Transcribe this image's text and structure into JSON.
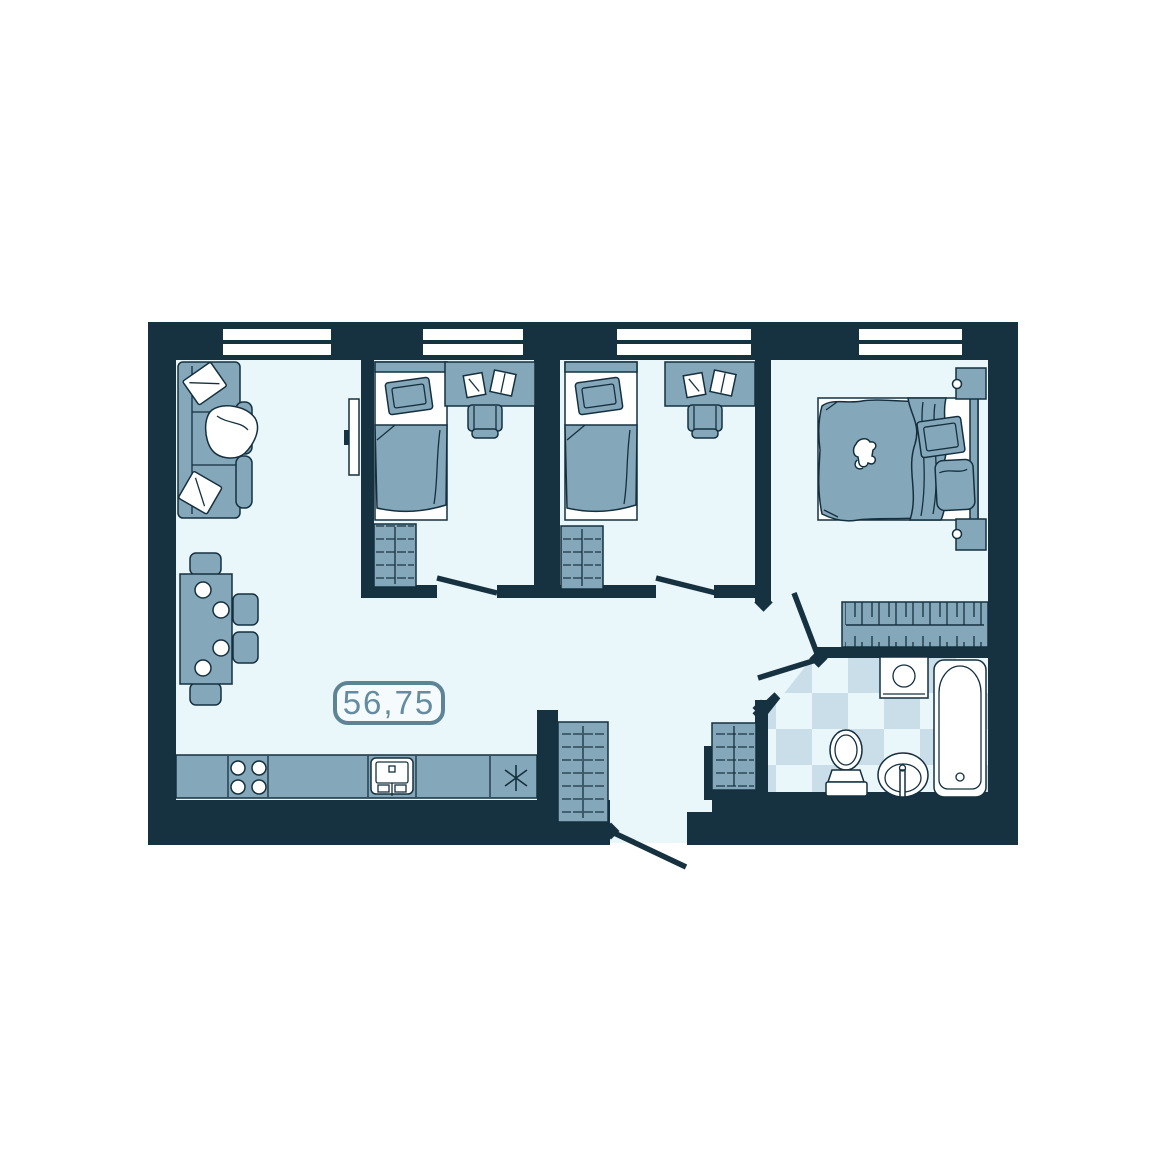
{
  "floor_plan": {
    "area_label": "56,75",
    "colors": {
      "page-bg": "#ffffff",
      "wall": "#16313f",
      "outline": "#14303e",
      "floor": "#e9f6fa",
      "furniture": "#85a7ba",
      "tile-dark": "#c9dee9",
      "tile-light": "#e9f6fa",
      "white": "#ffffff",
      "label": "#648ba0",
      "label-border": "#5d8495",
      "label-bg": "#f5fbfd"
    }
  }
}
